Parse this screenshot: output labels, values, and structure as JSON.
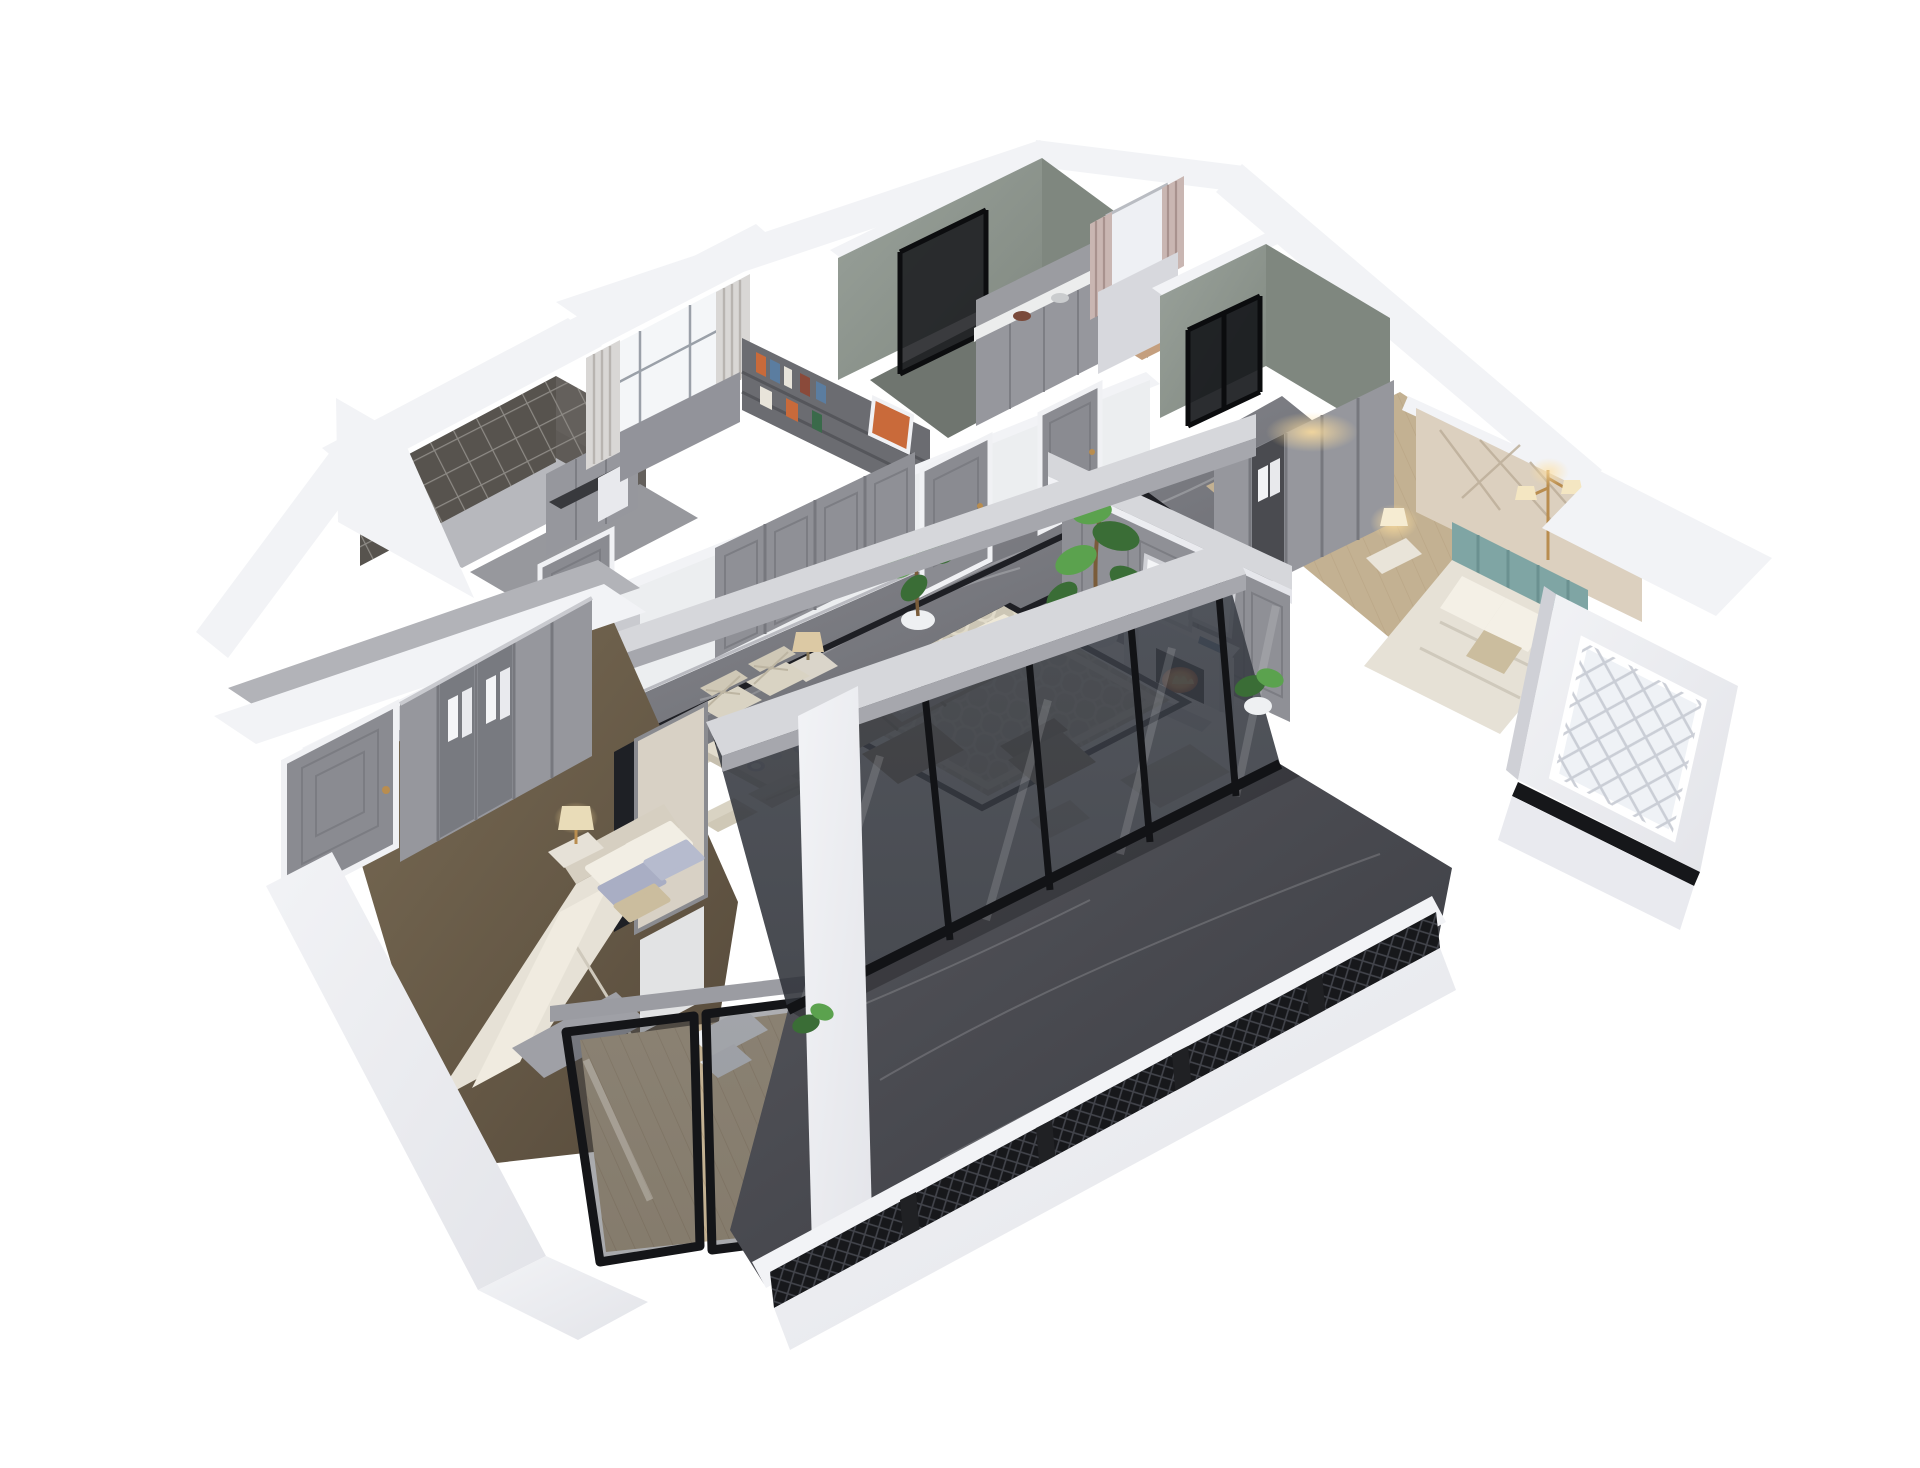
{
  "meta": {
    "title": "Photorealistic 3D isometric cutaway render of an apartment floor plan on a white background",
    "render_type": "dollhouse-axonometric",
    "background": "#ffffff"
  },
  "palette": {
    "bg": "#ffffff",
    "wallTop": "#f2f3f6",
    "wallSide": "#e3e4e9",
    "wallShade": "#cfd0d6",
    "grayWall": "#8f9096",
    "grayWallDark": "#77787e",
    "grayDoor": "#8a8b91",
    "grayCab": "#96979d",
    "beamTop": "#d6d7db",
    "beamSide": "#a6a7ad",
    "greenWall": "#9aa29b",
    "greenWallDark": "#7f877f",
    "marbleHi": "#95969c",
    "marbleLo": "#5e5f65",
    "terraceHi": "#56575d",
    "terraceLo": "#393a40",
    "inlay": "#1e1f24",
    "glass": "#2e3138",
    "frameBlack": "#141518",
    "latticeDark": "#57534e",
    "latticeLine": "#8d8a85",
    "woodLight": "#c3b192",
    "woodDark": "#a08663",
    "floorMasterHi": "#7a6c55",
    "floorMasterLo": "#55493a",
    "rugField": "#ccc6b5",
    "rugLine": "#eee8d7",
    "sofaBack": "#7e6d58",
    "sofaSeat": "#ab9e84",
    "cushion": "#c7beac",
    "tableCream": "#e2dccd",
    "chairCream": "#d9d3c3",
    "duvet": "#e6e1d6",
    "pillowBlue": "#a9aec4",
    "pillowTan": "#cbbd9e",
    "headboardCream": "#d6cfc1",
    "tealHeadboard": "#7fa5a4",
    "accentBeige": "#dcd0bf",
    "accentLine": "#bcae99",
    "fire": "#ff9a36",
    "fireGlow": "#ffd06e",
    "plantDark": "#3a6d36",
    "plantLight": "#5ba24e",
    "potWhite": "#eef0f2",
    "warmGlow": "#ffdf9e",
    "curtain": "#d9d7d5",
    "curtainStripe": "#b8b4b0",
    "pinkCurtain": "#c9b6b2",
    "pinkStripe": "#a8928e",
    "bookOrange": "#c96a3a",
    "bookBlue": "#5b7da0"
  },
  "scene": {
    "rooms": {
      "lattice_balcony": "Lattice screened balcony",
      "utility_corridor": "Utility corridor with cabinets",
      "study": "Study with window and bookshelf",
      "bathroom_1": "Bathroom with glass shower",
      "kitchen": "Kitchen cabinet run",
      "cloakroom": "Cloakroom with striped curtains",
      "bathroom_2": "Second bathroom with black glass door",
      "hallway": "Marble hallway with wardrobes and doors",
      "living_room": "Living room with fireplace",
      "dining_area": "Dining area with table for six",
      "bedroom_2": "Bedroom with teal headboard",
      "master_bedroom": "Master bedroom",
      "master_bay": "Master bedroom glazed bay",
      "bay_volume": "White bay-window volume with lattice window",
      "terrace": "Enclosed marble terrace with railing"
    },
    "furniture": {
      "fireplace": "White fireplace with burning fire",
      "sofa": "Leather sofa set",
      "coffee_table": "Coffee table",
      "dining_table": "Dining table with place settings",
      "master_bed": "Double bed with pillows",
      "guest_bed": "Double bed",
      "wardrobe": "Wardrobe with glazed doors",
      "monstera": "Monstera plant",
      "floor_lamp": "Brass floor lamp",
      "table_lamp": "Bedside lamp"
    }
  }
}
